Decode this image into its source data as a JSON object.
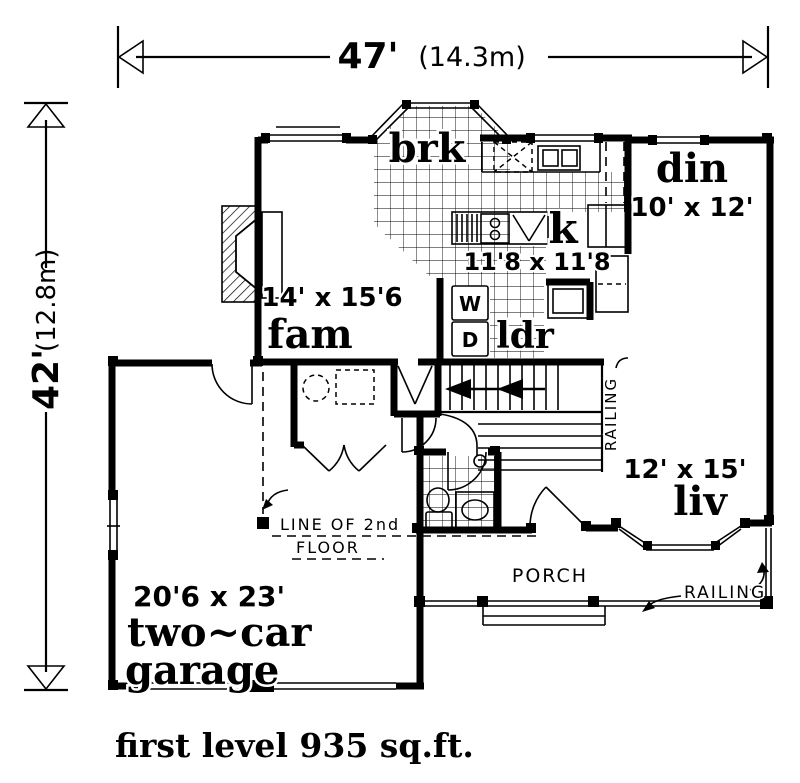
{
  "dimensions": {
    "width_ft": "47'",
    "width_m": "(14.3m)",
    "height_ft": "42'",
    "height_m": "(12.8m)"
  },
  "rooms": {
    "breakfast": {
      "label": "brk"
    },
    "dining": {
      "label": "din",
      "size": "10' x 12'"
    },
    "kitchen": {
      "label": "k",
      "size": "11'8 x 11'8"
    },
    "family": {
      "label": "fam",
      "size": "14' x 15'6"
    },
    "laundry": {
      "label": "ldr",
      "washer": "W",
      "dryer": "D"
    },
    "living": {
      "label": "liv",
      "size": "12' x 15'"
    },
    "garage": {
      "size": "20'6 x 23'",
      "label_line1": "two~car",
      "label_line2": "garage"
    },
    "porch": {
      "label": "PORCH"
    }
  },
  "annotations": {
    "stair_railing": "RAILING",
    "porch_railing": "RAILING",
    "second_floor_line_1": "LINE OF 2nd",
    "second_floor_line_2": "FLOOR"
  },
  "caption": "first level 935 sq.ft.",
  "colors": {
    "ink": "#000000",
    "paper": "#ffffff"
  }
}
